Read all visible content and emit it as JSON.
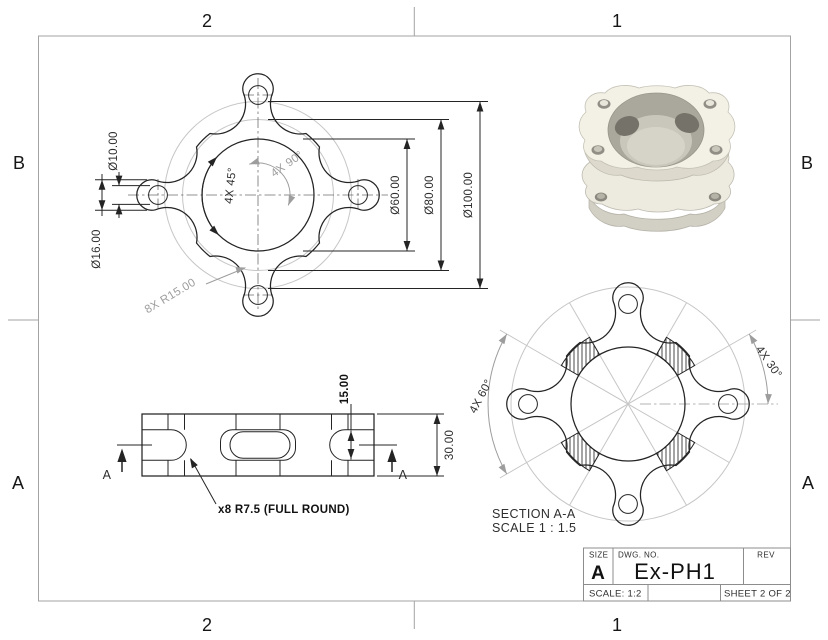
{
  "zones": {
    "top_left": "2",
    "top_right": "1",
    "bottom_left": "2",
    "bottom_right": "1",
    "left_top": "B",
    "left_bottom": "A",
    "right_top": "B",
    "right_bottom": "A"
  },
  "top_view": {
    "dim_phi10": "Ø10.00",
    "dim_phi16": "Ø16.00",
    "dim_phi60": "Ø60.00",
    "dim_phi80": "Ø80.00",
    "dim_phi100": "Ø100.00",
    "dim_angle45": "4X 45°",
    "dim_angle90": "4X 90°",
    "dim_radius": "8X R15.00"
  },
  "front_view": {
    "dim_15": "15.00",
    "dim_30": "30.00",
    "note": "x8 R7.5 (FULL ROUND)",
    "cut_label_left": "A",
    "cut_label_right": "A"
  },
  "section_view": {
    "dim_angle60": "4X 60°",
    "dim_angle30": "4X 30°",
    "caption_line1": "SECTION A-A",
    "caption_line2": "SCALE 1 : 1.5"
  },
  "title_block": {
    "size_label": "SIZE",
    "size_value": "A",
    "dwg_no_label": "DWG.  NO.",
    "dwg_no_value": "Ex-PH1",
    "rev_label": "REV",
    "scale_label": "SCALE: 1:2",
    "sheet_label": "SHEET 2 OF 2"
  },
  "colors": {
    "line_dark": "#242424",
    "line_gray": "#9d9d9d",
    "construction_gray": "#c6c6c6",
    "border_gray": "#a3a3a3",
    "part_ivory": "#f3f0e6",
    "part_wall": "#aaa79c"
  }
}
